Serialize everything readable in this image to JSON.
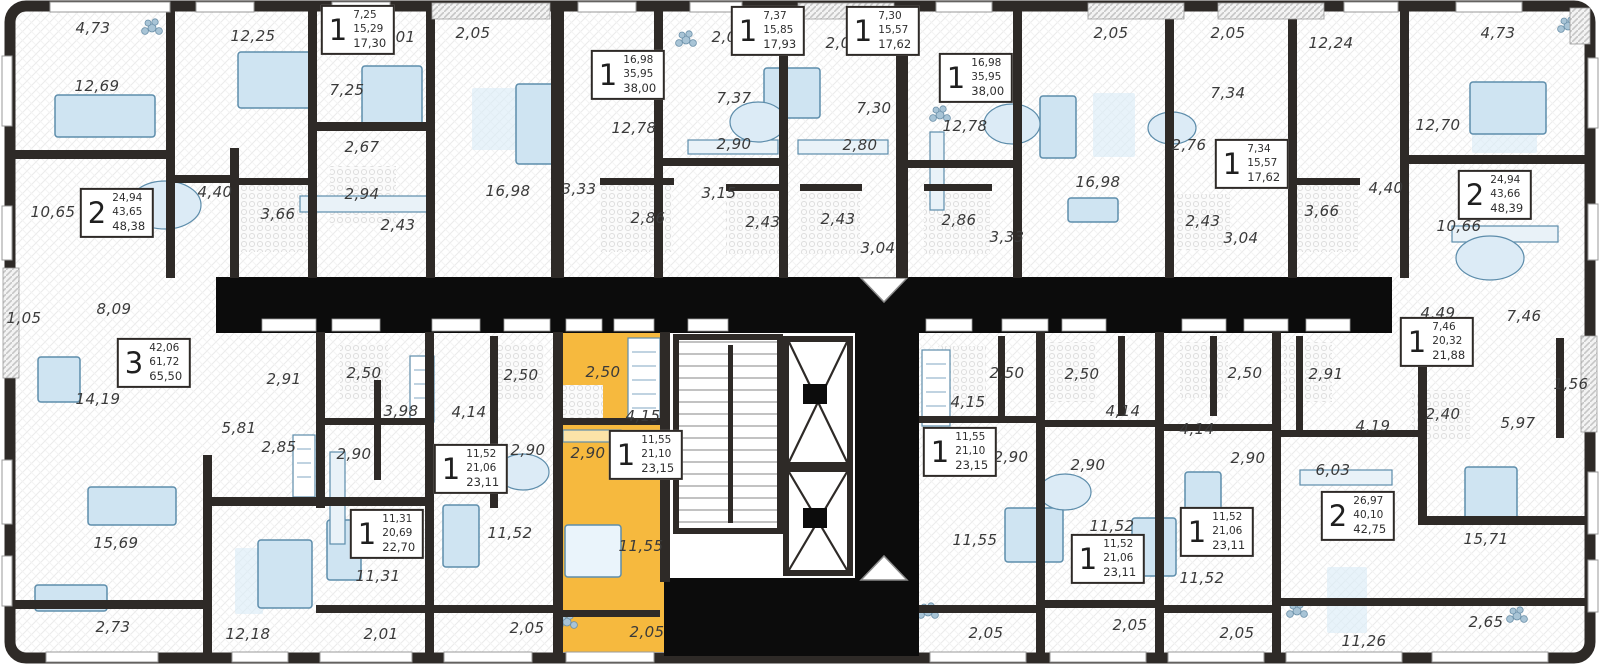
{
  "plan": {
    "colors": {
      "highlight": "#F6B93E",
      "wall": "#2E2A27",
      "void": "#0C0C0C",
      "furniture": "#CFE4F2"
    },
    "area_labels": [
      {
        "text": "4,73",
        "x": 93,
        "y": 28
      },
      {
        "text": "12,25",
        "x": 253,
        "y": 36
      },
      {
        "text": "2,01",
        "x": 398,
        "y": 37
      },
      {
        "text": "2,05",
        "x": 473,
        "y": 33
      },
      {
        "text": "12,69",
        "x": 97,
        "y": 86
      },
      {
        "text": "7,25",
        "x": 347,
        "y": 90
      },
      {
        "text": "2,67",
        "x": 362,
        "y": 147
      },
      {
        "text": "4,40",
        "x": 215,
        "y": 192
      },
      {
        "text": "2,94",
        "x": 362,
        "y": 194
      },
      {
        "text": "10,65",
        "x": 53,
        "y": 212
      },
      {
        "text": "3,66",
        "x": 278,
        "y": 214
      },
      {
        "text": "2,43",
        "x": 398,
        "y": 225
      },
      {
        "text": "16,98",
        "x": 508,
        "y": 191
      },
      {
        "text": "3,33",
        "x": 579,
        "y": 189
      },
      {
        "text": "12,78",
        "x": 634,
        "y": 128
      },
      {
        "text": "2,86",
        "x": 648,
        "y": 218
      },
      {
        "text": "2,08",
        "x": 729,
        "y": 37
      },
      {
        "text": "7,37",
        "x": 734,
        "y": 98
      },
      {
        "text": "2,90",
        "x": 734,
        "y": 144
      },
      {
        "text": "3,15",
        "x": 719,
        "y": 193
      },
      {
        "text": "2,43",
        "x": 763,
        "y": 222
      },
      {
        "text": "2,05",
        "x": 843,
        "y": 43
      },
      {
        "text": "7,30",
        "x": 874,
        "y": 108
      },
      {
        "text": "2,80",
        "x": 860,
        "y": 145
      },
      {
        "text": "2,43",
        "x": 838,
        "y": 219
      },
      {
        "text": "3,04",
        "x": 878,
        "y": 248
      },
      {
        "text": "12,78",
        "x": 965,
        "y": 126
      },
      {
        "text": "2,86",
        "x": 959,
        "y": 220
      },
      {
        "text": "2,05",
        "x": 1111,
        "y": 33
      },
      {
        "text": "16,98",
        "x": 1098,
        "y": 182
      },
      {
        "text": "3,33",
        "x": 1007,
        "y": 237
      },
      {
        "text": "2,76",
        "x": 1189,
        "y": 145
      },
      {
        "text": "2,43",
        "x": 1203,
        "y": 221
      },
      {
        "text": "3,04",
        "x": 1241,
        "y": 238
      },
      {
        "text": "2,05",
        "x": 1228,
        "y": 33
      },
      {
        "text": "7,34",
        "x": 1228,
        "y": 93
      },
      {
        "text": "12,24",
        "x": 1331,
        "y": 43
      },
      {
        "text": "3,66",
        "x": 1322,
        "y": 211
      },
      {
        "text": "4,40",
        "x": 1386,
        "y": 188
      },
      {
        "text": "12,70",
        "x": 1438,
        "y": 125
      },
      {
        "text": "4,73",
        "x": 1498,
        "y": 33
      },
      {
        "text": "10,66",
        "x": 1459,
        "y": 226
      },
      {
        "text": "1,05",
        "x": 24,
        "y": 318
      },
      {
        "text": "8,09",
        "x": 114,
        "y": 309
      },
      {
        "text": "14,19",
        "x": 98,
        "y": 399
      },
      {
        "text": "5,81",
        "x": 239,
        "y": 428
      },
      {
        "text": "2,85",
        "x": 279,
        "y": 447
      },
      {
        "text": "15,69",
        "x": 116,
        "y": 543
      },
      {
        "text": "2,73",
        "x": 113,
        "y": 627
      },
      {
        "text": "12,18",
        "x": 248,
        "y": 634
      },
      {
        "text": "2,91",
        "x": 284,
        "y": 379
      },
      {
        "text": "2,50",
        "x": 364,
        "y": 373
      },
      {
        "text": "3,98",
        "x": 401,
        "y": 411
      },
      {
        "text": "2,90",
        "x": 354,
        "y": 454
      },
      {
        "text": "11,31",
        "x": 378,
        "y": 576
      },
      {
        "text": "2,01",
        "x": 381,
        "y": 634
      },
      {
        "text": "2,50",
        "x": 521,
        "y": 375
      },
      {
        "text": "4,14",
        "x": 469,
        "y": 412
      },
      {
        "text": "2,90",
        "x": 528,
        "y": 450
      },
      {
        "text": "11,52",
        "x": 510,
        "y": 533
      },
      {
        "text": "2,05",
        "x": 527,
        "y": 628
      },
      {
        "text": "2,50",
        "x": 603,
        "y": 372
      },
      {
        "text": "4,15",
        "x": 643,
        "y": 416
      },
      {
        "text": "2,90",
        "x": 588,
        "y": 453
      },
      {
        "text": "11,55",
        "x": 641,
        "y": 546
      },
      {
        "text": "2,05",
        "x": 647,
        "y": 632
      },
      {
        "text": "2,50",
        "x": 1007,
        "y": 373
      },
      {
        "text": "4,15",
        "x": 968,
        "y": 402
      },
      {
        "text": "2,90",
        "x": 1011,
        "y": 457
      },
      {
        "text": "11,55",
        "x": 975,
        "y": 540
      },
      {
        "text": "2,05",
        "x": 986,
        "y": 633
      },
      {
        "text": "2,50",
        "x": 1082,
        "y": 374
      },
      {
        "text": "4,14",
        "x": 1123,
        "y": 411
      },
      {
        "text": "2,90",
        "x": 1088,
        "y": 465
      },
      {
        "text": "11,52",
        "x": 1112,
        "y": 526
      },
      {
        "text": "2,05",
        "x": 1130,
        "y": 625
      },
      {
        "text": "2,50",
        "x": 1245,
        "y": 373
      },
      {
        "text": "4,14",
        "x": 1197,
        "y": 429
      },
      {
        "text": "2,90",
        "x": 1248,
        "y": 458
      },
      {
        "text": "11,52",
        "x": 1202,
        "y": 578
      },
      {
        "text": "2,05",
        "x": 1237,
        "y": 633
      },
      {
        "text": "2,91",
        "x": 1326,
        "y": 374
      },
      {
        "text": "4,19",
        "x": 1373,
        "y": 426
      },
      {
        "text": "6,03",
        "x": 1333,
        "y": 470
      },
      {
        "text": "11,26",
        "x": 1364,
        "y": 641
      },
      {
        "text": "15,71",
        "x": 1486,
        "y": 539
      },
      {
        "text": "2,65",
        "x": 1486,
        "y": 622
      },
      {
        "text": "2,40",
        "x": 1443,
        "y": 414
      },
      {
        "text": "5,97",
        "x": 1518,
        "y": 423
      },
      {
        "text": "1,56",
        "x": 1571,
        "y": 384
      },
      {
        "text": "4,49",
        "x": 1438,
        "y": 313
      },
      {
        "text": "7,46",
        "x": 1524,
        "y": 316
      }
    ],
    "unit_boxes": [
      {
        "rooms": "1",
        "values": [
          "7,25",
          "15,29",
          "17,30"
        ],
        "x": 358,
        "y": 30,
        "highlighted": false
      },
      {
        "rooms": "1",
        "values": [
          "16,98",
          "35,95",
          "38,00"
        ],
        "x": 628,
        "y": 75,
        "highlighted": false
      },
      {
        "rooms": "1",
        "values": [
          "7,37",
          "15,85",
          "17,93"
        ],
        "x": 768,
        "y": 31,
        "highlighted": false
      },
      {
        "rooms": "1",
        "values": [
          "7,30",
          "15,57",
          "17,62"
        ],
        "x": 883,
        "y": 31,
        "highlighted": false
      },
      {
        "rooms": "1",
        "values": [
          "16,98",
          "35,95",
          "38,00"
        ],
        "x": 976,
        "y": 78,
        "highlighted": false
      },
      {
        "rooms": "1",
        "values": [
          "7,34",
          "15,57",
          "17,62"
        ],
        "x": 1252,
        "y": 164,
        "highlighted": false
      },
      {
        "rooms": "2",
        "values": [
          "24,94",
          "43,66",
          "48,39"
        ],
        "x": 1495,
        "y": 195,
        "highlighted": false
      },
      {
        "rooms": "2",
        "values": [
          "24,94",
          "43,65",
          "48,38"
        ],
        "x": 117,
        "y": 213,
        "highlighted": false
      },
      {
        "rooms": "3",
        "values": [
          "42,06",
          "61,72",
          "65,50"
        ],
        "x": 154,
        "y": 363,
        "highlighted": false
      },
      {
        "rooms": "1",
        "values": [
          "11,31",
          "20,69",
          "22,70"
        ],
        "x": 387,
        "y": 534,
        "highlighted": false
      },
      {
        "rooms": "1",
        "values": [
          "11,52",
          "21,06",
          "23,11"
        ],
        "x": 471,
        "y": 469,
        "highlighted": false
      },
      {
        "rooms": "1",
        "values": [
          "11,55",
          "21,10",
          "23,15"
        ],
        "x": 646,
        "y": 455,
        "highlighted": true
      },
      {
        "rooms": "1",
        "values": [
          "11,55",
          "21,10",
          "23,15"
        ],
        "x": 960,
        "y": 452,
        "highlighted": false
      },
      {
        "rooms": "1",
        "values": [
          "11,52",
          "21,06",
          "23,11"
        ],
        "x": 1108,
        "y": 559,
        "highlighted": false
      },
      {
        "rooms": "1",
        "values": [
          "11,52",
          "21,06",
          "23,11"
        ],
        "x": 1217,
        "y": 532,
        "highlighted": false
      },
      {
        "rooms": "2",
        "values": [
          "26,97",
          "40,10",
          "42,75"
        ],
        "x": 1358,
        "y": 516,
        "highlighted": false
      },
      {
        "rooms": "1",
        "values": [
          "7,46",
          "20,32",
          "21,88"
        ],
        "x": 1437,
        "y": 342,
        "highlighted": false
      }
    ]
  }
}
